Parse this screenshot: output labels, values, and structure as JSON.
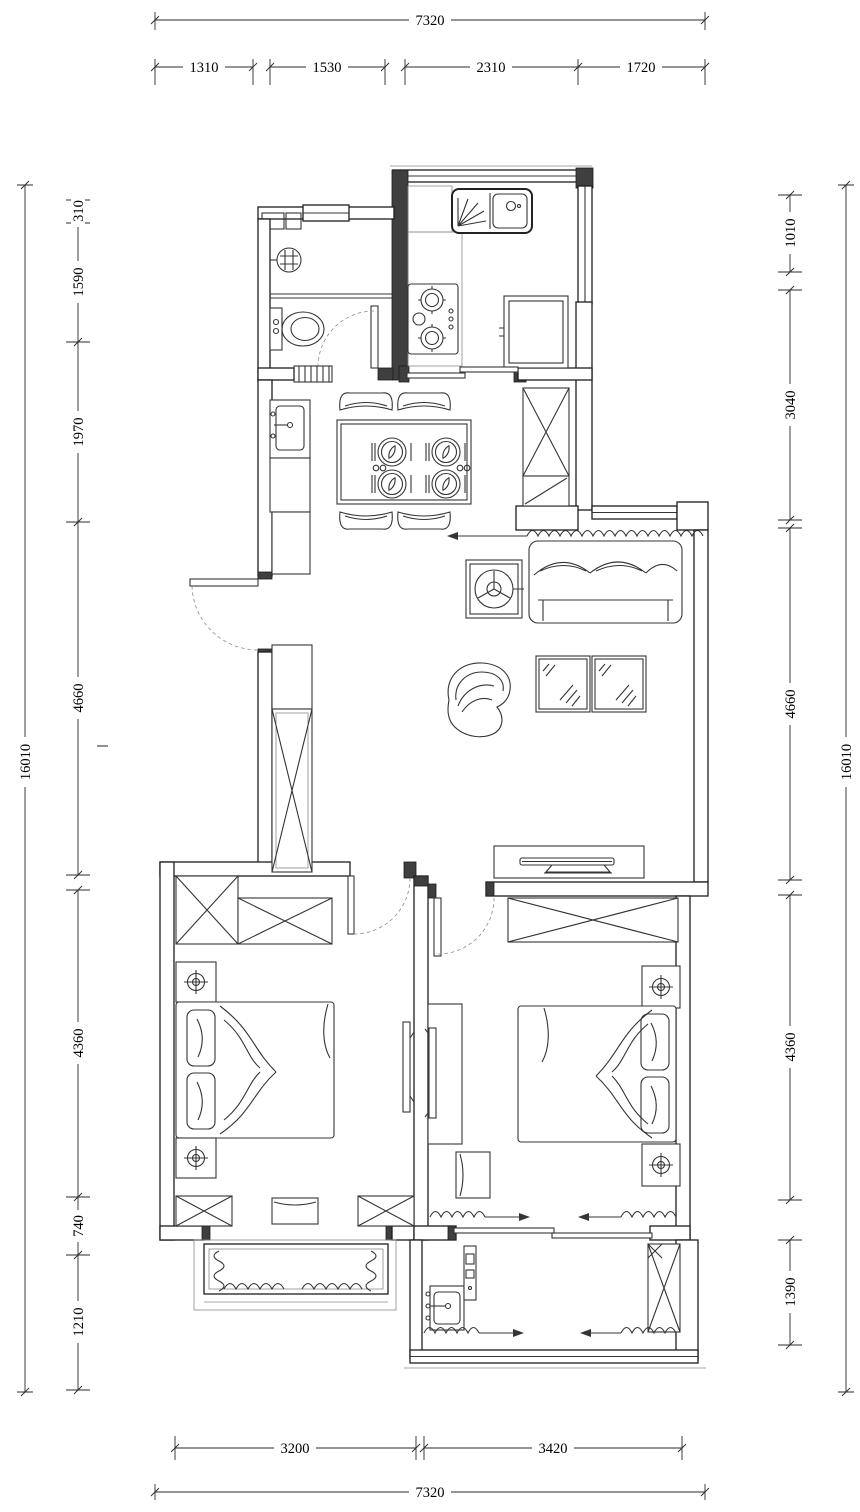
{
  "meta": {
    "drawing_type": "residential floor plan (CAD line drawing)",
    "units": "mm",
    "colors": {
      "line": "#2b2b2b",
      "wall_fill": "#ffffff",
      "post_fill": "#3f3f3f",
      "background": "#ffffff"
    }
  },
  "dimensions": {
    "top": {
      "overall": "7320",
      "segments": [
        "1310",
        "1530",
        "2310",
        "1720"
      ]
    },
    "bottom": {
      "overall": "7320",
      "segments": [
        "3200",
        "3420"
      ]
    },
    "left": {
      "overall": "16010",
      "segments": [
        "310",
        "1590",
        "1970",
        "4660",
        "4360",
        "740",
        "1210"
      ]
    },
    "right": {
      "overall": "16010",
      "segments": [
        "1010",
        "3040",
        "4660",
        "4360",
        "1390"
      ]
    }
  },
  "legend_symbols": [
    "kitchen-sink-symbol",
    "gas-stove-symbol",
    "fridge-symbol",
    "toilet-symbol",
    "floor-drain-symbol",
    "wash-basin-symbol",
    "dining-table-4-seat-symbol",
    "wardrobe-x-symbol",
    "sofa-symbol",
    "fan-unit-symbol",
    "coffee-table-symbol",
    "lounge-chair-symbol",
    "tv-cabinet-symbol",
    "double-bed-symbol",
    "nightstand-lamp-symbol",
    "wall-tv-symbol",
    "bench-symbol",
    "bay-window-curtain-symbol",
    "sliding-door-symbol",
    "door-swing-symbol",
    "laundry-sink-symbol",
    "curtain-arrow-symbol"
  ]
}
